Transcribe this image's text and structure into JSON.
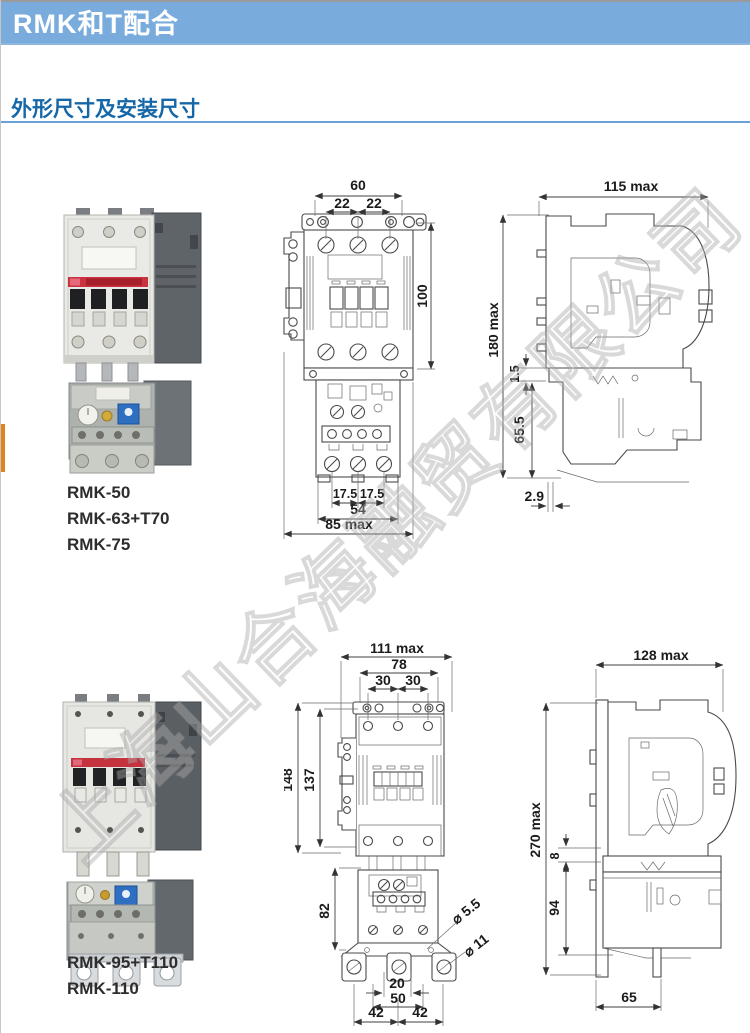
{
  "banner": {
    "title": "RMK和T配合"
  },
  "section": {
    "title": "外形尺寸及安装尺寸"
  },
  "watermark": "上海山合海融贸有限公司",
  "colors": {
    "banner_blue": "#79acdc",
    "title_blue": "#1667a8",
    "underline_blue": "#68a2d8",
    "tab_orange": "#e2831c",
    "relay_dial_blue": "#2f6fc1",
    "contactor_red_strip": "#c9333f"
  },
  "row1": {
    "models": [
      "RMK-50",
      "RMK-63+T70",
      "RMK-75"
    ],
    "front": {
      "w60": "60",
      "w22a": "22",
      "w22b": "22",
      "h100": "100",
      "b175a": "17.5",
      "b175b": "17.5",
      "b54": "54",
      "b85": "85  max"
    },
    "side": {
      "d115": "115  max",
      "h180": "180  max",
      "g15": "1.5",
      "h655": "65.5",
      "o29": "2.9"
    }
  },
  "row2": {
    "models": [
      "RMK-95+T110",
      "RMK-110"
    ],
    "front": {
      "w111": "111 max",
      "w78": "78",
      "w30a": "30",
      "w30b": "30",
      "h148": "148",
      "h137": "137",
      "h82": "82",
      "dia55": "⌀ 5.5",
      "dia11": "⌀ 11",
      "b20": "20",
      "b50": "50",
      "b42a": "42",
      "b42b": "42"
    },
    "side": {
      "d128": "128 max",
      "h270": "270 max",
      "g8": "8",
      "h94": "94",
      "b65": "65"
    }
  }
}
